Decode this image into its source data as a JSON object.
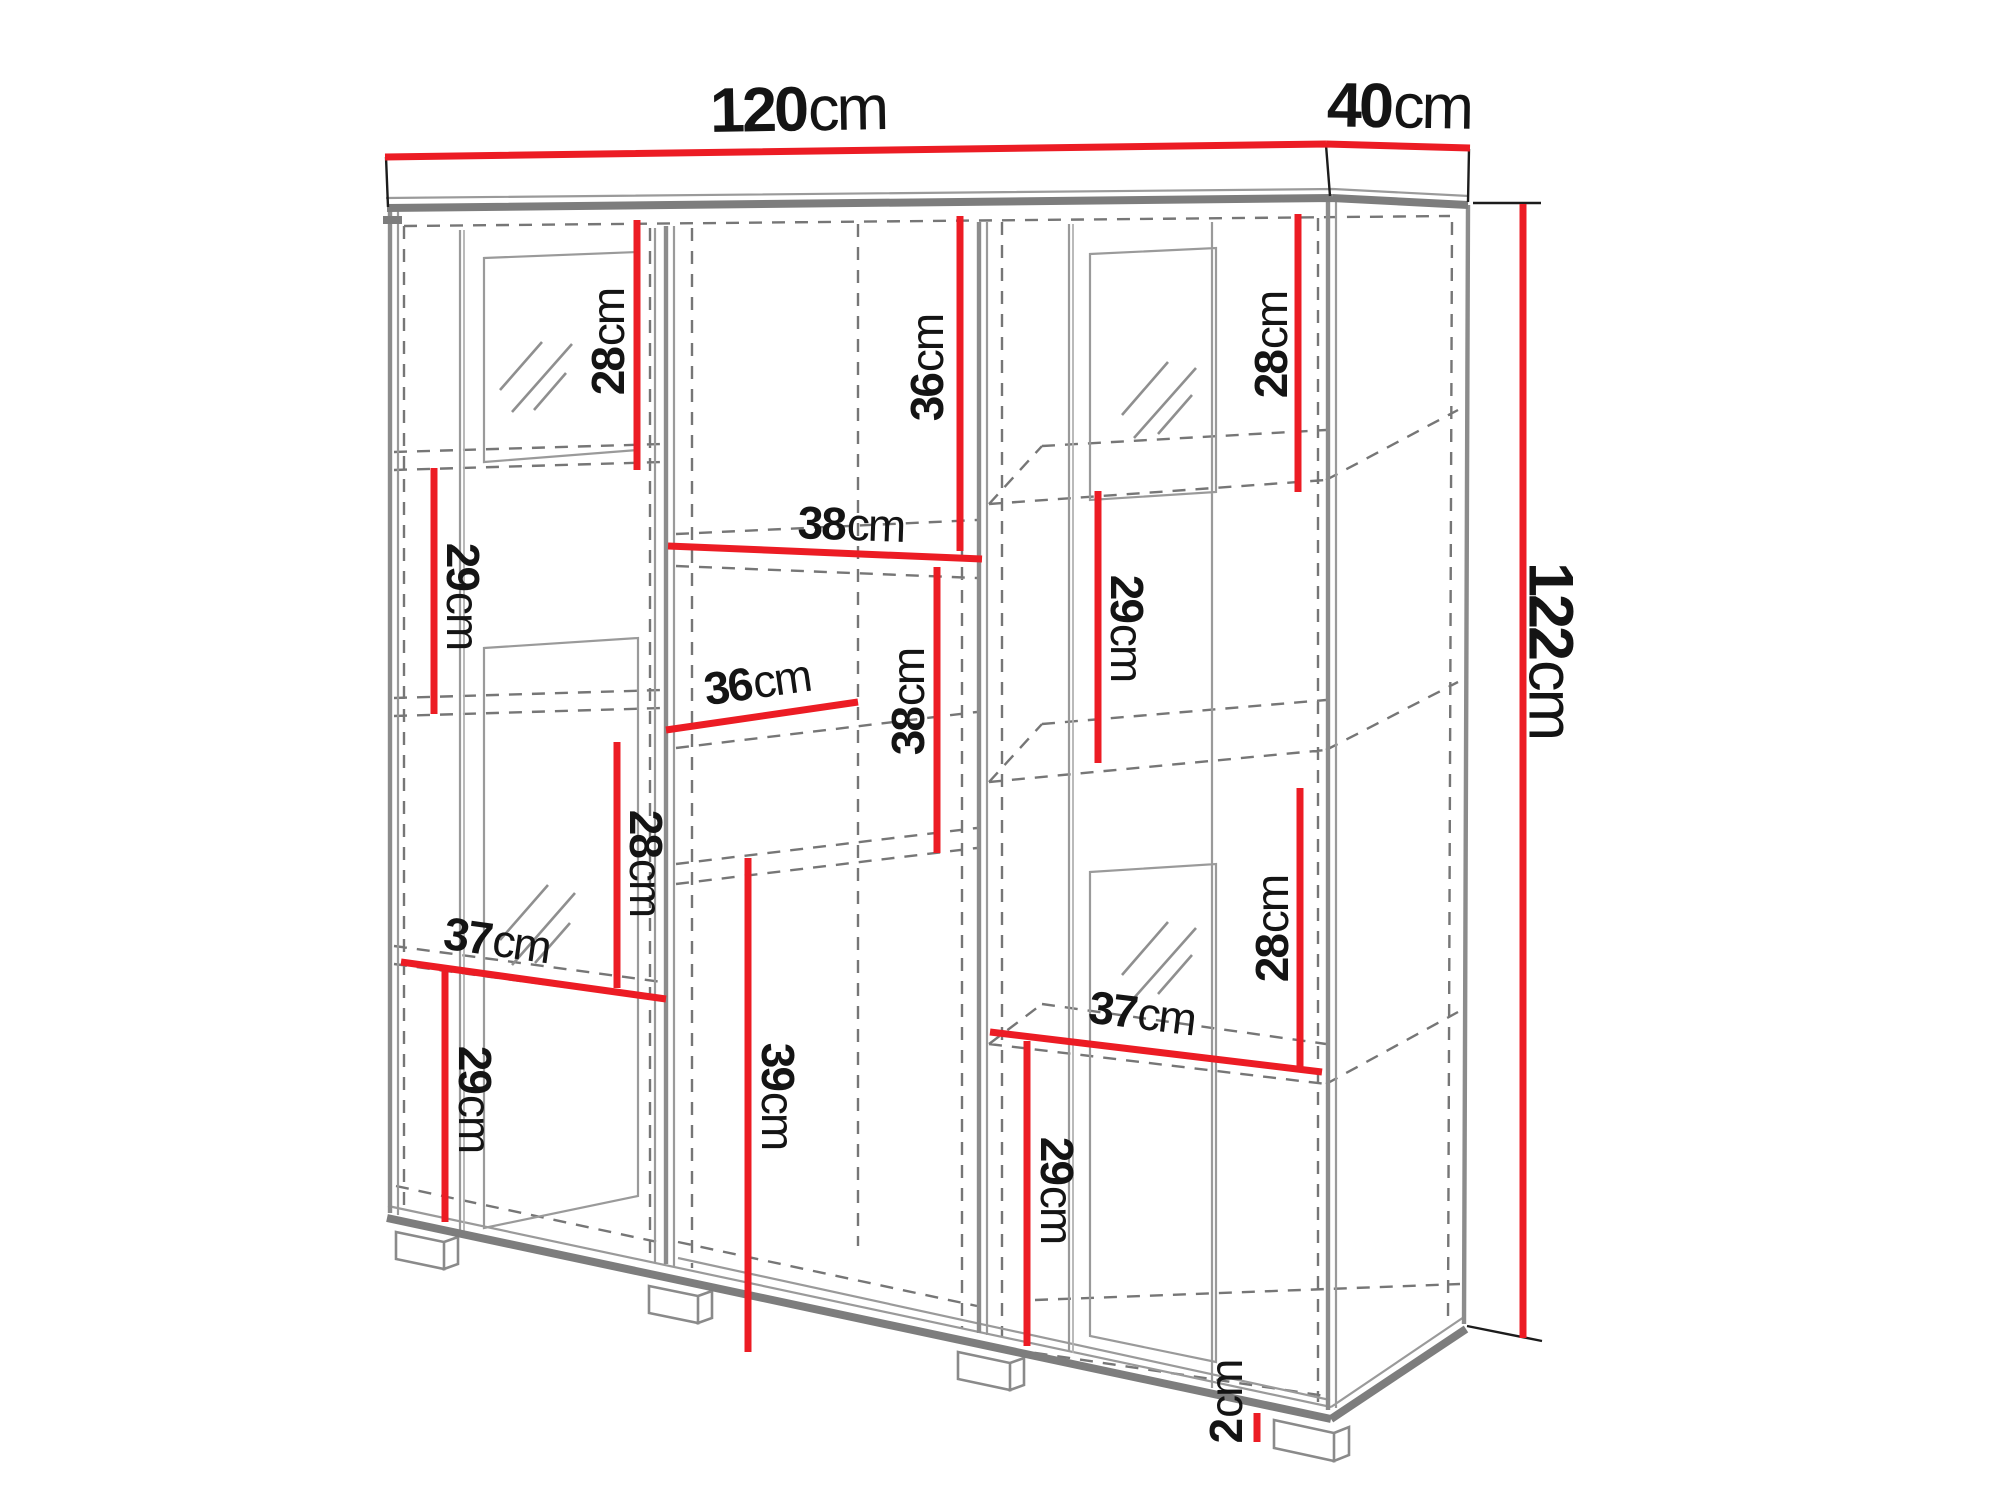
{
  "diagram": {
    "type": "furniture-dimension-diagram",
    "subject": "three-door display cabinet with glass doors, shelves and feet"
  },
  "colors": {
    "dimension_red": "#ec1c24",
    "cabinet_gray": "#7d7d7d",
    "dashed_gray": "#767676",
    "text_black": "#141414"
  },
  "dims": {
    "width": {
      "value": "120",
      "unit": "cm"
    },
    "depth": {
      "value": "40",
      "unit": "cm"
    },
    "height": {
      "value": "122",
      "unit": "cm"
    },
    "foot": {
      "value": "2",
      "unit": "cm"
    },
    "l_top": {
      "value": "28",
      "unit": "cm"
    },
    "m_top": {
      "value": "36",
      "unit": "cm"
    },
    "r_top": {
      "value": "28",
      "unit": "cm"
    },
    "l_mid": {
      "value": "29",
      "unit": "cm"
    },
    "m_shelf38": {
      "value": "38",
      "unit": "cm"
    },
    "r_mid": {
      "value": "29",
      "unit": "cm"
    },
    "m_shelf36": {
      "value": "36",
      "unit": "cm"
    },
    "m_38": {
      "value": "38",
      "unit": "cm"
    },
    "l_28": {
      "value": "28",
      "unit": "cm"
    },
    "l_shelf37": {
      "value": "37",
      "unit": "cm"
    },
    "l_bottom": {
      "value": "29",
      "unit": "cm"
    },
    "m_39": {
      "value": "39",
      "unit": "cm"
    },
    "r_28": {
      "value": "28",
      "unit": "cm"
    },
    "r_shelf37": {
      "value": "37",
      "unit": "cm"
    },
    "r_bottom": {
      "value": "29",
      "unit": "cm"
    }
  }
}
